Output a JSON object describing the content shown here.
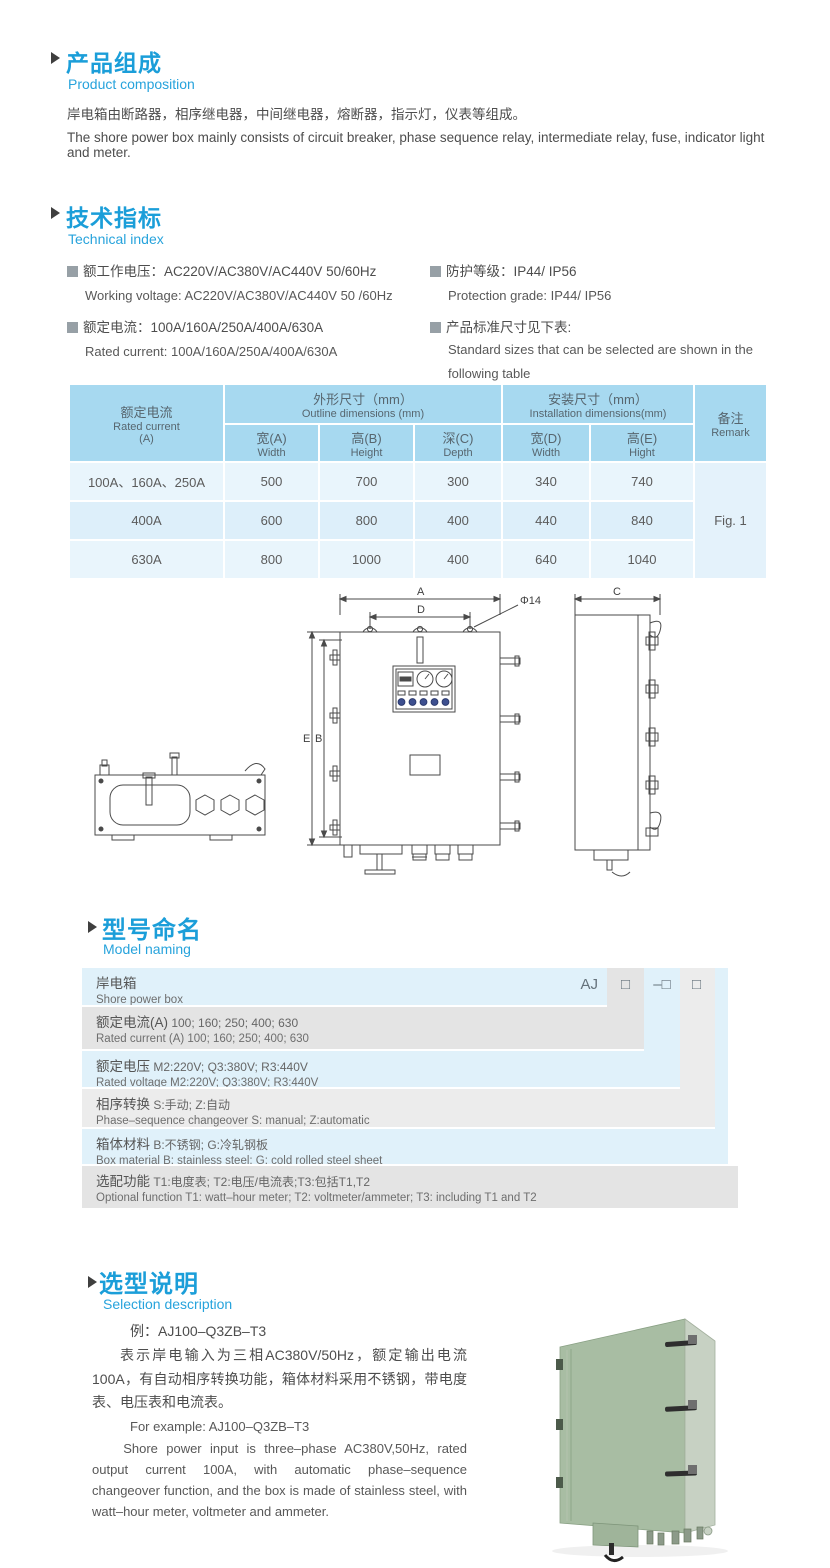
{
  "colors": {
    "accent_blue": "#1b9ed9",
    "sub_heading_blue": "#27a3dc",
    "table_header_bg": "#a7d9f0",
    "table_row_light": "#e9f5fc",
    "table_row_dark": "#ddeffa",
    "model_row_blue": "#e0f1fa",
    "model_row_gray": "#e4e4e4",
    "photo_front_green": "#a8bda3",
    "photo_side_green": "#c7d1c3"
  },
  "product_composition": {
    "heading_cn": "产品组成",
    "heading_en": "Product  composition",
    "para_cn": "岸电箱由断路器，相序继电器，中间继电器，熔断器，指示灯，仪表等组成。",
    "para_en": "The shore power box mainly consists of circuit breaker, phase sequence relay, intermediate relay, fuse, indicator light and meter."
  },
  "technical_index": {
    "heading_cn": "技术指标",
    "heading_en": "Technical index",
    "left": [
      {
        "cn": "额工作电压：AC220V/AC380V/AC440V  50/60Hz",
        "en": "Working voltage: AC220V/AC380V/AC440V 50 /60Hz"
      },
      {
        "cn": "额定电流：100A/160A/250A/400A/630A",
        "en": "Rated current: 100A/160A/250A/400A/630A"
      }
    ],
    "right": [
      {
        "cn": "防护等级：IP44/ IP56",
        "en": "Protection grade: IP44/ IP56"
      },
      {
        "cn": "产品标准尺寸见下表:",
        "en_line1": "Standard  sizes  that  can  be  selected  are  shown  in  the",
        "en_line2": "following table"
      }
    ]
  },
  "dimensions_table": {
    "header": {
      "rated_cn": "额定电流",
      "rated_en": "Rated current",
      "rated_unit": "(A)",
      "outline_cn": "外形尺寸（mm）",
      "outline_en": "Outline dimensions (mm)",
      "install_cn": "安装尺寸（mm）",
      "install_en": "Installation dimensions(mm)",
      "remark_cn": "备注",
      "remark_en": "Remark",
      "sub": [
        {
          "cn": "宽(A)",
          "en": "Width"
        },
        {
          "cn": "高(B)",
          "en": "Height"
        },
        {
          "cn": "深(C)",
          "en": "Depth"
        },
        {
          "cn": "宽(D)",
          "en": "Width"
        },
        {
          "cn": "高(E)",
          "en": "Hight"
        }
      ]
    },
    "rows": [
      {
        "cells": [
          "100A、160A、250A",
          "500",
          "700",
          "300",
          "340",
          "740"
        ]
      },
      {
        "cells": [
          "400A",
          "600",
          "800",
          "400",
          "440",
          "840"
        ]
      },
      {
        "cells": [
          "630A",
          "800",
          "1000",
          "400",
          "640",
          "1040"
        ]
      }
    ],
    "remark_value": "Fig. 1"
  },
  "drawing": {
    "dim_a": "A",
    "dim_d": "D",
    "dia": "Φ14",
    "dim_e": "E",
    "dim_b": "B",
    "dim_c": "C"
  },
  "model_naming": {
    "heading_cn": "型号命名",
    "heading_en": "Model naming",
    "code": {
      "prefix": "AJ",
      "box1": "□",
      "box2": "–□",
      "box3": "□"
    },
    "rows": [
      {
        "cn_label": "岸电箱",
        "cn_value": "",
        "en": "Shore power box"
      },
      {
        "cn_label": "额定电流(A)",
        "cn_value": " 100; 160; 250; 400; 630",
        "en": "Rated current (A) 100; 160; 250; 400; 630"
      },
      {
        "cn_label": "额定电压",
        "cn_value": "  M2:220V;  Q3:380V;  R3:440V",
        "en": "Rated voltage  M2:220V;  Q3:380V;  R3:440V"
      },
      {
        "cn_label": "相序转换",
        "cn_value": "  S:手动; Z:自动",
        "en": "Phase–sequence changeover  S: manual;  Z:automatic"
      },
      {
        "cn_label": "箱体材料",
        "cn_value": "   B:不锈钢;  G:冷轧钢板",
        "en": "Box material   B: stainless steel; G: cold rolled steel sheet"
      },
      {
        "cn_label": "选配功能",
        "cn_value": "    T1:电度表;  T2:电压/电流表;T3:包括T1,T2",
        "en": "Optional function  T1: watt–hour meter; T2: voltmeter/ammeter; T3: including T1 and T2"
      }
    ]
  },
  "selection_description": {
    "heading_cn": "选型说明",
    "heading_en": "Selection description",
    "example_cn": "例：AJ100–Q3ZB–T3",
    "para_cn": "表示岸电输入为三相AC380V/50Hz，额定输出电流100A，有自动相序转换功能，箱体材料采用不锈钢，带电度表、电压表和电流表。",
    "example_en": "For example: AJ100–Q3ZB–T3",
    "para_en": "Shore power input is three–phase AC380V,50Hz, rated output current 100A, with automatic phase–sequence changeover function, and the box is made of stainless steel, with watt–hour meter, voltmeter and ammeter."
  }
}
